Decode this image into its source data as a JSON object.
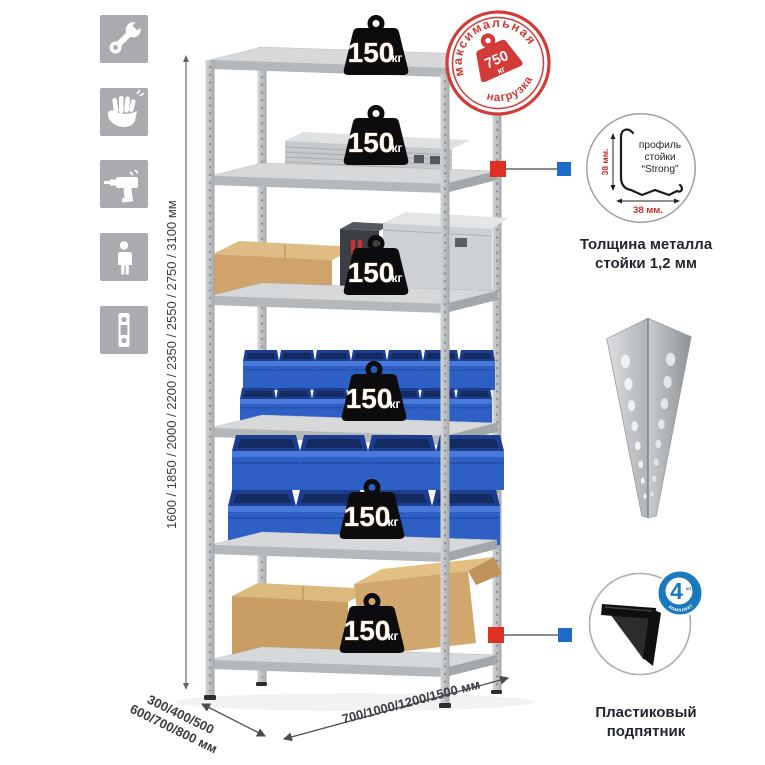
{
  "sidebar_icons": [
    {
      "name": "wrench-icon"
    },
    {
      "name": "glove-icon"
    },
    {
      "name": "drill-icon"
    },
    {
      "name": "person-icon"
    },
    {
      "name": "level-icon"
    }
  ],
  "shelves": [
    {
      "load": "150",
      "unit": "кг"
    },
    {
      "load": "150",
      "unit": "кг"
    },
    {
      "load": "150",
      "unit": "кг"
    },
    {
      "load": "150",
      "unit": "кг"
    },
    {
      "load": "150",
      "unit": "кг"
    },
    {
      "load": "150",
      "unit": "кг"
    }
  ],
  "stamp": {
    "arc_top": "максимальная",
    "arc_bottom": "нагрузка",
    "value": "750",
    "unit": "кг"
  },
  "dimensions": {
    "height": "1600 / 1850 / 2000 / 2200 / 2350 / 2550 / 2750 / 3100 мм",
    "depth_line1": "300/400/500",
    "depth_line2": "600/700/800 мм",
    "width": "700/1000/1200/1500 мм"
  },
  "profile_detail": {
    "label_line1": "профиль",
    "label_line2": "стойки",
    "label_line3": "“Strong”",
    "dim_vertical": "38 мм.",
    "dim_horizontal": "38 мм.",
    "caption_line1": "Толщина металла",
    "caption_line2": "стойки 1,2 мм"
  },
  "foot_detail": {
    "badge_value": "4",
    "badge_small": "штуки",
    "badge_arc": "в комплекте",
    "caption_line1": "Пластиковый",
    "caption_line2": "подпятник"
  },
  "colors": {
    "stamp_red": "#d23b38",
    "marker_red": "#e03024",
    "marker_blue": "#1e6bc8",
    "bin_blue": "#2e5fc4",
    "badge_blue": "#1879bf",
    "icon_tile_gray": "#a9abae",
    "weight_black": "#0c0c0e"
  }
}
